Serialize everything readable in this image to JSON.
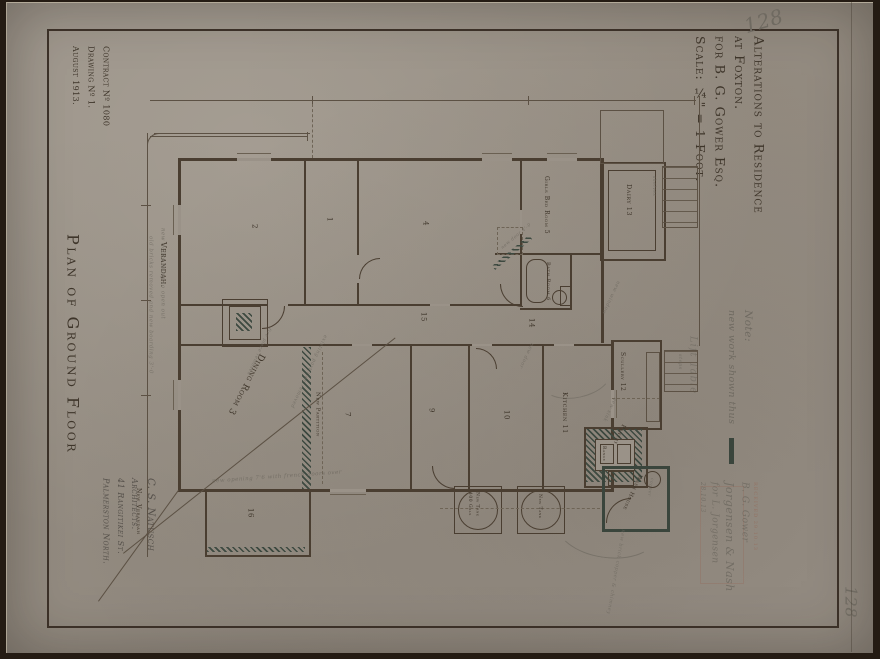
{
  "sheet": {
    "number_top": "128",
    "number_bottom": "128"
  },
  "title_block": {
    "line1": "Alterations to Residence",
    "line2": "at Foxton.",
    "line3": "for B. G. Gower Esq.",
    "line4": "Scale: ¼\" = 1-Foot."
  },
  "margin_left": {
    "contract": "Contract Nº 1080",
    "drawing": "Drawing Nº 1.",
    "date": "August 1913.",
    "plan_title": "Plan of Ground Floor",
    "architect_name": "C. S. Natusch",
    "architect_role": "Architects.",
    "architect_street": "41 Rangitikei St.",
    "architect_city": "Palmerston North."
  },
  "note": {
    "label": "Note:",
    "text": "new work shown thus"
  },
  "stamps": {
    "stamp1": "RECEIVED 29.10.13",
    "sig1": "B. G. Gower",
    "sig2": "Jorgensen & Nash",
    "sig3": "for L. Jorgensen",
    "date": "28.10.13",
    "lift_table": "Lift Table"
  },
  "rooms": {
    "verandah": "Verandah.",
    "new_verandah": "New Verandah",
    "r1": "1",
    "r2": "2",
    "r4": "4",
    "r7": "7",
    "r9": "9",
    "r10": "10",
    "hall15": "15",
    "hall14": "14",
    "r16": "16",
    "girls_bed": "Girls Bed Room 5",
    "dairy": "Dairy 13",
    "bath": "Bath Room 6",
    "dining": "Dining Room 3",
    "kitchen": "Kitchen 11",
    "scullery": "Scullery 12",
    "pantry": "Pantry",
    "wash_house": "Wash House",
    "tank1a": "New Tank",
    "tank1b": "400 Gals",
    "tank2": "New Tank",
    "range": "Range"
  },
  "annotations": {
    "wall_note1": "new doors hung to open out",
    "wall_note2": "old bricks removed and new boarding 3'-0",
    "new_partition": "New Partition",
    "partition_removed": "existing partition removed",
    "fireplace_removed": "fire place removed",
    "french_doors": "new opening 7'6 with french doors over",
    "new_door2": "new door 4'-0",
    "new_door": "new door",
    "new_window": "new window",
    "shelves": "shelves",
    "new_sink": "new sink",
    "steps": "steps",
    "copper": "copper",
    "new_copper": "new brick copper & chimney"
  },
  "colors": {
    "paper": "#9a9288",
    "frame": "#241b13",
    "ink": "#4a3e31",
    "pencil": "#6f6a61",
    "new_work": "#3d4940",
    "stamp": "#946e5e"
  }
}
